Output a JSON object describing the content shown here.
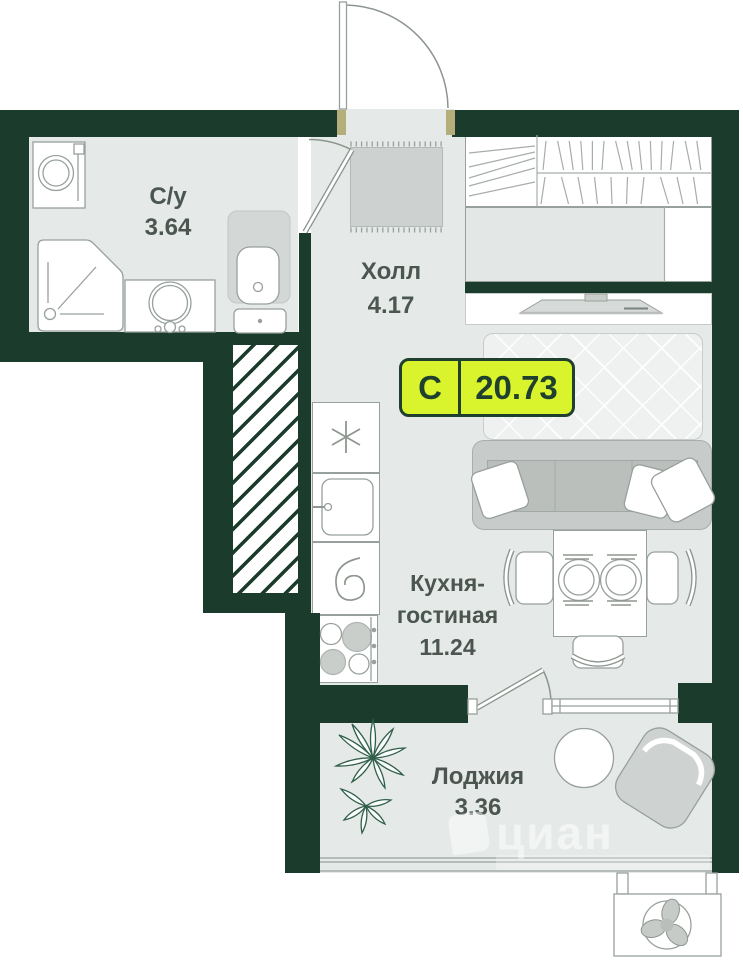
{
  "badge": {
    "category": "С",
    "area": "20.73"
  },
  "rooms": {
    "bathroom": {
      "name": "С/у",
      "area": "3.64"
    },
    "hall": {
      "name": "Холл",
      "area": "4.17"
    },
    "kitchen_living": {
      "name": "Кухня-гостиная",
      "area": "11.24"
    },
    "loggia": {
      "name": "Лоджия",
      "area": "3.36"
    }
  },
  "watermark": {
    "text": "циан"
  },
  "icons": {
    "fridge": "snowflake-icon",
    "cooker_hood": "spiral-icon",
    "air_conditioner": "fan-icon"
  },
  "colors": {
    "wall": "#1b3c2c",
    "floor": "#e5e9e7",
    "line": "#98a09c",
    "label_ink": "#4b5650",
    "badge_bg": "#d9f42c",
    "badge_ink": "#20402f"
  }
}
